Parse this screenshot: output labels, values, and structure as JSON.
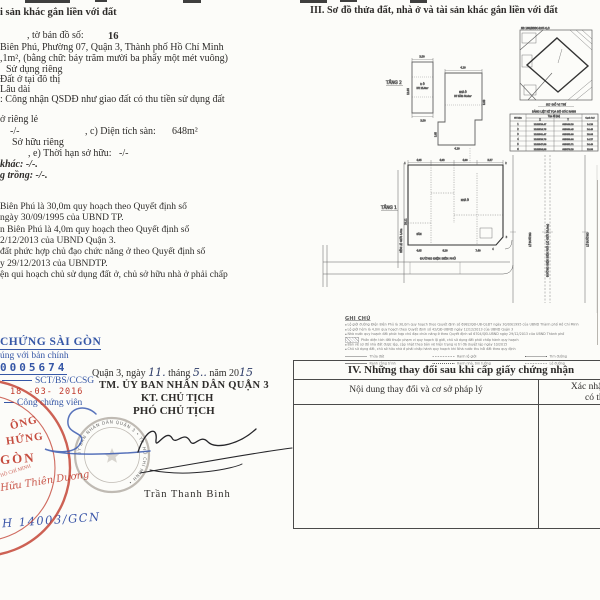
{
  "left": {
    "body": [
      "i sản khác gắn liền với đất",
      ", tờ bản đồ số:",
      "16",
      "Biên Phú, Phường 07, Quận 3, Thành phố Hồ Chí Minh",
      ",1m², (bằng chữ: bảy trăm mười ba phẩy một mét vuông)",
      "Sử dụng riêng",
      "Đất ở tại đô thị",
      "Lâu dài",
      ": Công nhận QSDĐ như giao đất có thu tiền sử dụng đất",
      "ở riêng lẻ",
      "-/-",
      ", c) Diện tích sàn:",
      "648m²",
      "Sở hữu riêng",
      ", e) Thời hạn sở hữu:",
      "-/-",
      "khác: -/-.",
      "g trồng: -/-.",
      "Biên Phú là 30,0m quy hoạch theo Quyết định số",
      "ngày 30/09/1995 của UBND TP.",
      "n Biên Phú là 4,0m quy hoạch theo Quyết định số",
      "2/12/2013 của UBND Quận 3.",
      "đất phức hợp chủ đạo chức năng ở theo Quyết định số",
      "y 29/12/2013 của UBNDTP.",
      "ện qui hoạch chủ sử dụng đất ở, chủ sở hữu nhà ở phải chấp"
    ],
    "notary": {
      "title": "CHỨNG SÀI GÒN",
      "line1": "úng với bản chính",
      "number": "0005674",
      "code": "SCT/BS/CCSG",
      "date": "18 -03- 2016",
      "role": "Công chứng viên"
    },
    "red_stamp": {
      "w1": "ÔNG",
      "w2": "HỨNG",
      "w3": "GÒN",
      "arc": "HỒ CHÍ MINH",
      "script": "Hữu Thiên Dương"
    },
    "signing": {
      "date_prefix": "Quận 3, ngày",
      "day": "11.",
      "thang": "tháng",
      "month": "5..",
      "nam": "năm 20",
      "year": "15",
      "line1": "TM. ỦY BAN NHÂN DÂN QUẬN 3",
      "line2": "KT. CHỦ TỊCH",
      "line3": "PHÓ CHỦ TỊCH",
      "signer": "Trần Thanh Bình"
    },
    "seal_text": "ỦY BAN NHÂN DÂN QUẬN 3 • TP. HỒ CHÍ MINH •",
    "ref_code": "H 14003/GCN"
  },
  "right": {
    "section3_title": "III. Sơ đồ thửa đất, nhà ở và tài sản khác gắn liền với đất",
    "plan2": {
      "label": "TẦNG 2",
      "room": "P. Ở",
      "area": "DT: 25,8m²",
      "dim_top": "3.50",
      "dim_bottom": "3.50",
      "dim_side": "12.85"
    },
    "plan3": {
      "room": "NHÀ Ở",
      "area": "DT SÀN: 48,6m²",
      "dim_top": "4.10",
      "dim_side": "8.60",
      "dim_bottom": "4.10",
      "dim_step": "3.05"
    },
    "locmap": {
      "title": "SĐ 160/BĐĐC-P.07-Q.3",
      "caption": "SƠ ĐỒ VỊ TRÍ"
    },
    "coords": {
      "title": "BẢNG LIỆT KÊ TỌA ĐỘ GÓC RANH",
      "h_no": "Số hiệu",
      "h_toado": "Tọa độ (m)",
      "h_x": "X",
      "h_y": "Y",
      "h_canh": "Cạnh (m)",
      "rows": [
        [
          "1",
          "1192528.47",
          "605846.28",
          "14.28"
        ],
        [
          "2",
          "1192524.75",
          "605860.45",
          "24.45"
        ],
        [
          "3",
          "1192501.47",
          "605853.08",
          "28.06"
        ],
        [
          "4",
          "1192528.79",
          "605838.64",
          "14.27"
        ],
        [
          "5",
          "1192547.58",
          "605852.71",
          "24.49"
        ],
        [
          "6",
          "1192534.38",
          "605876.28",
          "13.98"
        ]
      ]
    },
    "plan1": {
      "label": "TẦNG 1",
      "yard": "SÂN",
      "house": "NHÀ Ở",
      "dims_top": [
        "4.95",
        "4.93",
        "4.90",
        "5.57"
      ],
      "dims_bottom": [
        "4.95",
        "6.20",
        "7.40"
      ],
      "dim_left": "20,11",
      "alley": "HẺM LỘ GIỚI 4,0m",
      "street_bottom": "ĐƯỜNG ĐIỆN BIÊN PHỦ",
      "street_right": "ĐƯỜNG ĐIỆN BIÊN PHỦ (LỘ GIỚI 30,0m)",
      "sidewalk_left": "LỀ ĐƯỜNG",
      "sidewalk_right": "LỀ ĐƯỜNG",
      "corners": [
        "1",
        "2",
        "3",
        "4"
      ]
    },
    "notes": {
      "title": "GHI CHÚ",
      "items": [
        "Lộ giới đường Điện Biên Phủ là 30,0m quy hoạch theo Quyết định số 6982/QĐ-UB-QLĐT ngày 30/09/1995 của UBND Thành phố Hồ Chí Minh",
        "Lộ giới hẻm là 4,0m quy hoạch theo Quyết định số 42/QĐ-UBND ngày 12/12/2013 của UBND Quận 3",
        "Nhà nước quy hoạch đất phức hợp chủ đạo chức năng ở theo Quyết định số 6704/QĐ-UBND ngày 29/12/2013 của UBND Thành phố",
        "Phần diện tích đất thuộc phạm vi quy hoạch lộ giới, chủ sử dụng đất phải chấp hành quy hoạch",
        "Bản vẽ sơ đồ nhà đất được lập, cập nhật theo bản vẽ hiện trạng vị trí đã duyệt lập ngày 10/2015",
        "Chủ sử dụng đất, chủ sở hữu nhà ở phải chấp hành quy hoạch khi Nhà nước thu hồi đất theo quy định"
      ],
      "legend": [
        "Thửa đất",
        "Ranh lộ giới",
        "Tim đường",
        "Ranh công trình",
        "Ranh nhà, tim tường",
        "Lề đường"
      ]
    },
    "section4": {
      "title": "IV. Những thay đổi sau khi cấp giấy chứng nhận",
      "col1": "Nội dung thay đổi và cơ sở pháp lý",
      "col2a": "Xác nhận của cơ quan",
      "col2b": "có thẩm quyền"
    }
  }
}
